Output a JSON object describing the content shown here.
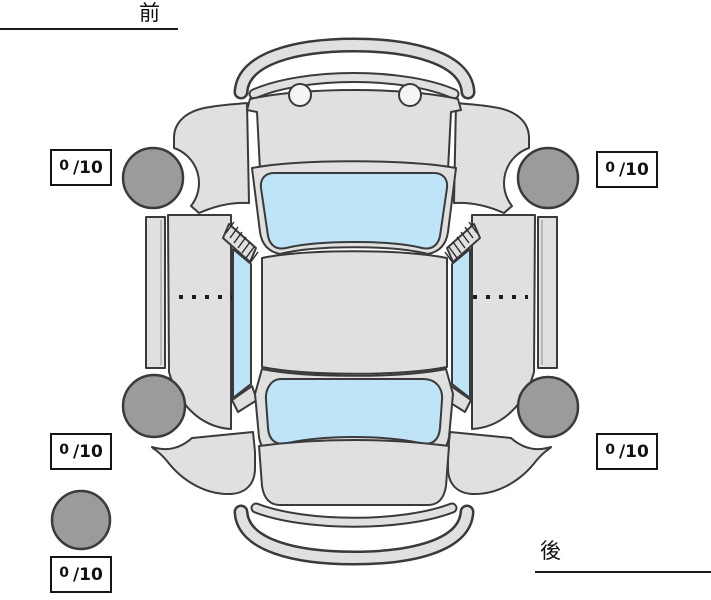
{
  "diagram": {
    "name": "vehicle-tire-condition-diagram",
    "labels": {
      "front": "前",
      "rear": "後"
    },
    "scores": {
      "front_left": {
        "value": "0",
        "max": "/10"
      },
      "front_right": {
        "value": "0",
        "max": "/10"
      },
      "rear_left": {
        "value": "0",
        "max": "/10"
      },
      "rear_right": {
        "value": "0",
        "max": "/10"
      },
      "spare": {
        "value": "0",
        "max": "/10"
      }
    },
    "colors": {
      "background": "#ffffff",
      "body_panel": "#e0e0e1",
      "glass": "#bfe3f7",
      "tire": "#9b9b9b",
      "outline": "#3a3a3a",
      "text": "#111111"
    }
  }
}
